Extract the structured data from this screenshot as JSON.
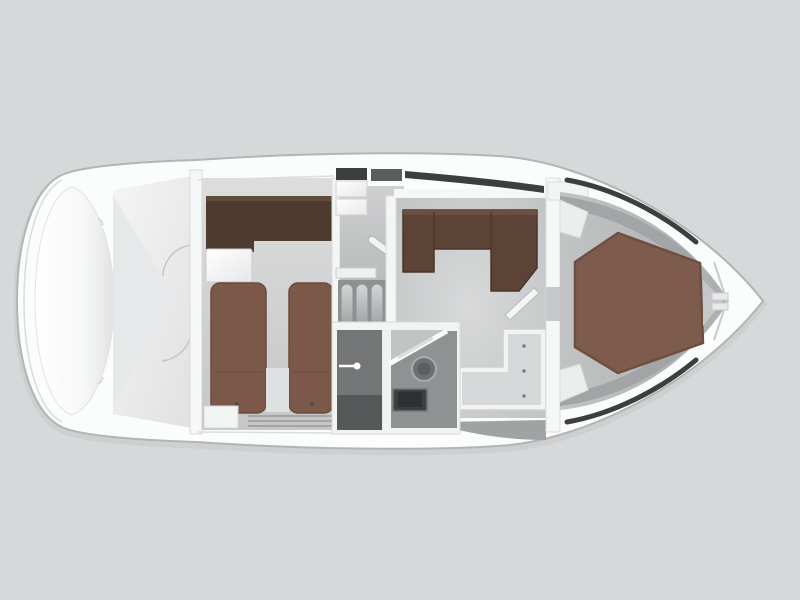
{
  "meta": {
    "title": "Motor yacht interior floor plan, top-down view, bow pointing right"
  },
  "palette": {
    "background": "#d7d8d9",
    "hull_white": "#fbfcfc",
    "hull_outline": "#b2b4b5",
    "floor_light": "#d8d9da",
    "floor_mid": "#c2c4c5",
    "floor_dark": "#9ea0a1",
    "furniture_white": "#f2f3f3",
    "upholstery_dark_brown": "#4e3a2f",
    "mattress_brown": "#7b5848",
    "sofa_brown": "#5d4336",
    "bed_brown": "#7d5c4d",
    "wet_room_gray": "#737576",
    "wet_room_light": "#8f9192",
    "window_slot_dark": "#3c3e3f",
    "window_slot_mid": "#5a5c5d",
    "step_gray": "#b3b5b6",
    "fixture_dark": "#6d6f70",
    "sink_dark": "#3d3f40"
  },
  "scene": {
    "type": "yacht-interior-floorplan",
    "orientation": "bow-right",
    "areas": [
      {
        "id": "stern-sunpad",
        "kind": "sunpad-cushion"
      },
      {
        "id": "aft-deck",
        "kind": "open-deck",
        "door_swing_arcs": 2
      },
      {
        "id": "guest-cabin",
        "kind": "cabin",
        "berths": 2,
        "furniture": [
          "l-shaped-headboard-sofa",
          "nightstand",
          "single-berth-left",
          "single-berth-right"
        ]
      },
      {
        "id": "companionway",
        "kind": "stairs",
        "steps": 4,
        "furniture": [
          "handrail",
          "storage-boxes"
        ]
      },
      {
        "id": "wet-room",
        "kind": "bathroom",
        "fixtures": [
          "shower-cabin",
          "shower-door-handle",
          "toilet",
          "sink"
        ]
      },
      {
        "id": "salon",
        "kind": "dinette",
        "furniture": [
          "u-shaped-sofa",
          "open-door"
        ]
      },
      {
        "id": "galley",
        "kind": "galley",
        "furniture": [
          "l-shaped-counter"
        ],
        "knobs": 3
      },
      {
        "id": "bow-cabin",
        "kind": "cabin",
        "berths": 1,
        "furniture": [
          "hexagonal-double-berth",
          "side-benches"
        ]
      },
      {
        "id": "bow-locker",
        "kind": "anchor-locker"
      }
    ]
  }
}
